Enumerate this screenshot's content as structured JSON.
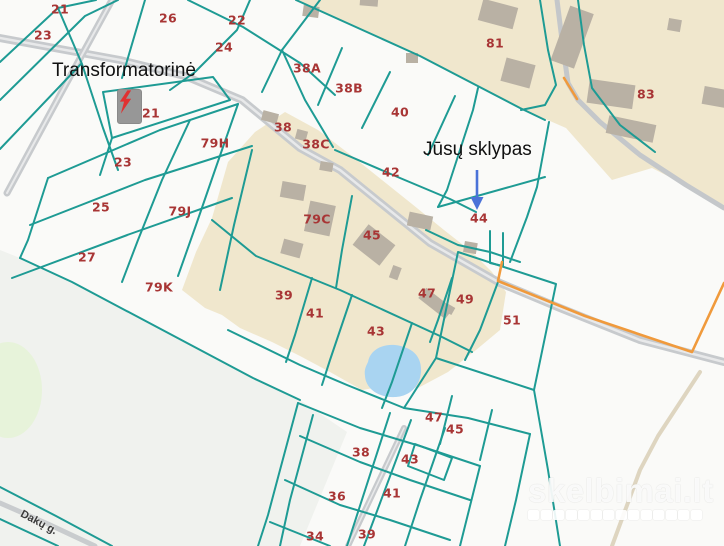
{
  "map": {
    "annotations": {
      "transformer_label": "Transformatorinė",
      "your_plot_label": "Jūsų sklypas",
      "street_label": "Dakų g."
    },
    "parcel_labels": [
      {
        "t": "21",
        "x": 60,
        "y": 9
      },
      {
        "t": "26",
        "x": 168,
        "y": 18
      },
      {
        "t": "22",
        "x": 237,
        "y": 20
      },
      {
        "t": "24",
        "x": 224,
        "y": 47
      },
      {
        "t": "23",
        "x": 43,
        "y": 35
      },
      {
        "t": "38A",
        "x": 307,
        "y": 68
      },
      {
        "t": "38B",
        "x": 349,
        "y": 88
      },
      {
        "t": "40",
        "x": 400,
        "y": 112
      },
      {
        "t": "81",
        "x": 495,
        "y": 43
      },
      {
        "t": "83",
        "x": 646,
        "y": 94
      },
      {
        "t": "21",
        "x": 151,
        "y": 113
      },
      {
        "t": "38",
        "x": 283,
        "y": 127
      },
      {
        "t": "38C",
        "x": 316,
        "y": 144
      },
      {
        "t": "79H",
        "x": 215,
        "y": 143
      },
      {
        "t": "23",
        "x": 123,
        "y": 162
      },
      {
        "t": "42",
        "x": 391,
        "y": 172
      },
      {
        "t": "25",
        "x": 101,
        "y": 207
      },
      {
        "t": "79J",
        "x": 180,
        "y": 211
      },
      {
        "t": "79C",
        "x": 317,
        "y": 219
      },
      {
        "t": "44",
        "x": 479,
        "y": 218
      },
      {
        "t": "45",
        "x": 372,
        "y": 235
      },
      {
        "t": "27",
        "x": 87,
        "y": 257
      },
      {
        "t": "79K",
        "x": 159,
        "y": 287
      },
      {
        "t": "39",
        "x": 284,
        "y": 295
      },
      {
        "t": "47",
        "x": 427,
        "y": 293
      },
      {
        "t": "49",
        "x": 465,
        "y": 299
      },
      {
        "t": "41",
        "x": 315,
        "y": 313
      },
      {
        "t": "51",
        "x": 512,
        "y": 320
      },
      {
        "t": "43",
        "x": 376,
        "y": 331
      },
      {
        "t": "47",
        "x": 434,
        "y": 417
      },
      {
        "t": "45",
        "x": 455,
        "y": 429
      },
      {
        "t": "38",
        "x": 361,
        "y": 452
      },
      {
        "t": "43",
        "x": 410,
        "y": 459
      },
      {
        "t": "36",
        "x": 337,
        "y": 496
      },
      {
        "t": "41",
        "x": 392,
        "y": 493
      },
      {
        "t": "34",
        "x": 315,
        "y": 536
      },
      {
        "t": "39",
        "x": 367,
        "y": 534
      }
    ],
    "watermark": {
      "text": "skelbimai.lt",
      "squares": 14
    },
    "colors": {
      "boundary_teal": "#1e9b94",
      "parcel_number": "#a83535",
      "built_area_beige": "#f0e7cd",
      "building_gray": "#b9b1a4",
      "road_gray": "#c7cacd",
      "road_stripe": "#e8e9ea",
      "pond_blue": "#a9d4f1",
      "orange_boundary": "#f09a3c",
      "arrow_blue": "#4a72d8",
      "lightning_red": "#e03131",
      "lawn_gray_green": "#f0f2ee",
      "green_patch": "#e7f3da"
    }
  }
}
